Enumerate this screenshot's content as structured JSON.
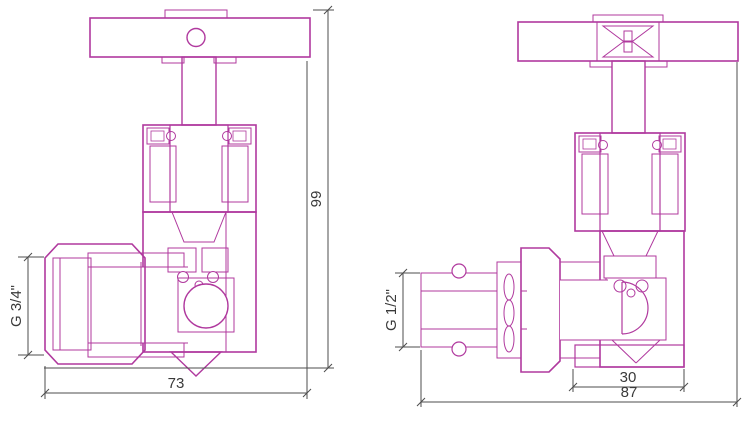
{
  "colors": {
    "drawing_line": "#b0399e",
    "hatch_line": "#cb7ec0",
    "dimension_line": "#4d4d4d",
    "text": "#3a3a3a",
    "background": "#ffffff"
  },
  "left_drawing": {
    "height_label": "99",
    "width_label": "73",
    "thread_label": "G 3/4\""
  },
  "right_drawing": {
    "overall_width_label": "87",
    "body_width_label": "30",
    "thread_label": "G 1/2\""
  }
}
